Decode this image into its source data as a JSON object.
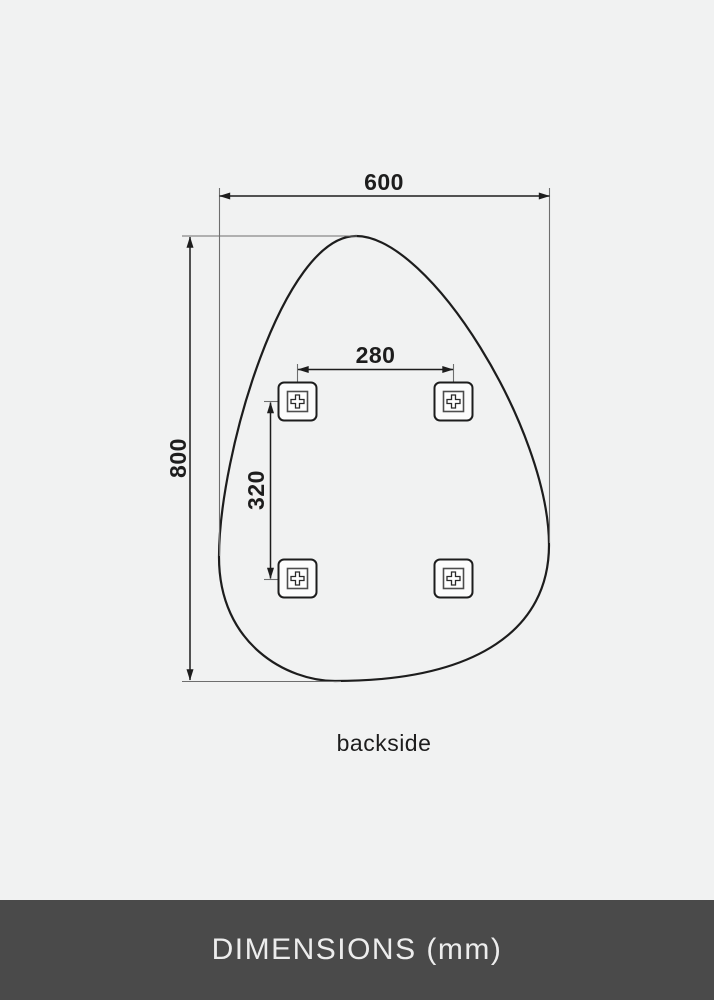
{
  "page": {
    "background": "#f1f2f2"
  },
  "drawing": {
    "outline_color": "#1d1d1d",
    "view_label": "backside",
    "bracket_count": 4,
    "dimensions": {
      "width": {
        "label": "600",
        "value_mm": 600
      },
      "height": {
        "label": "800",
        "value_mm": 800
      },
      "bracket_spacing_horizontal": {
        "label": "280",
        "value_mm": 280
      },
      "bracket_spacing_vertical": {
        "label": "320",
        "value_mm": 320
      }
    },
    "unit": "mm"
  },
  "footer": {
    "title": "DIMENSIONS (mm)",
    "background": "#4a4a4a",
    "text_color": "#ededed"
  }
}
